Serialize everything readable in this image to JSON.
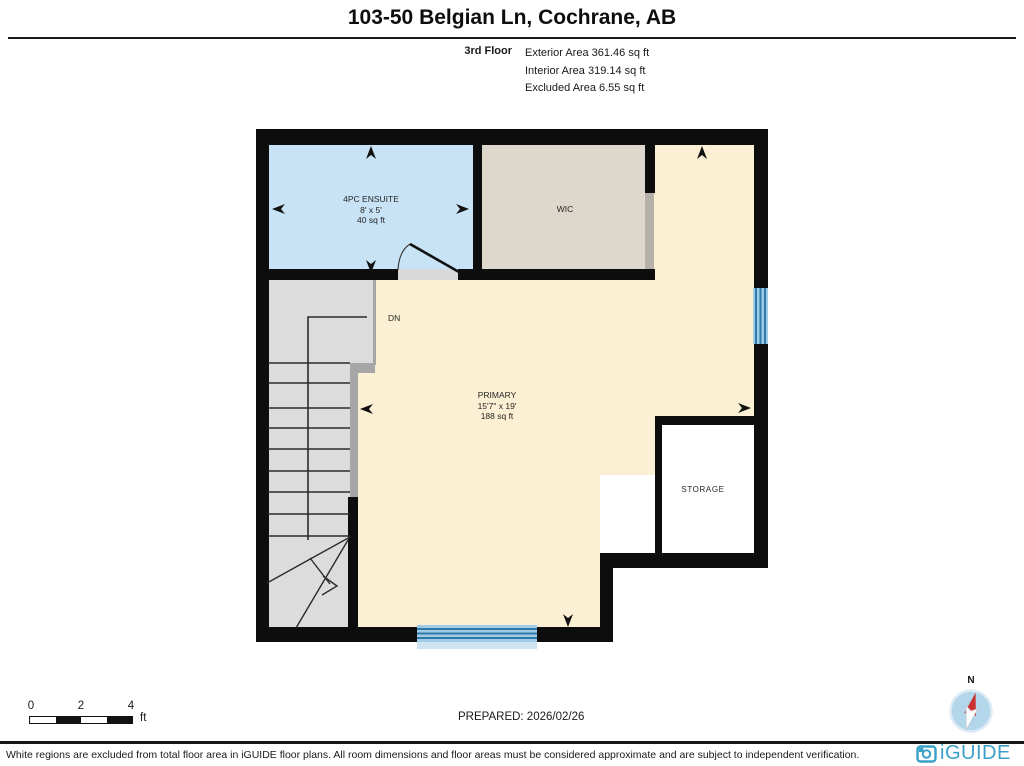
{
  "header": {
    "title": "103-50 Belgian Ln, Cochrane, AB",
    "floor_label": "3rd Floor",
    "exterior_area": "Exterior Area 361.46 sq ft",
    "interior_area": "Interior Area 319.14 sq ft",
    "excluded_area": "Excluded Area 6.55 sq ft"
  },
  "floorplan": {
    "rooms": {
      "ensuite": {
        "label": "4PC ENSUITE",
        "dims": "8' x 5'",
        "area": "40 sq ft",
        "fill": "#c7e3f5"
      },
      "wic": {
        "label": "WIC",
        "fill": "#ddd8cb"
      },
      "primary": {
        "label": "PRIMARY",
        "dims": "15'7\" x 19'",
        "area": "188 sq ft",
        "fill": "#fbf0d3"
      },
      "storage": {
        "label": "STORAGE",
        "fill": "#ffffff"
      },
      "stairs": {
        "label": "DN",
        "fill": "#dcdcdc"
      }
    },
    "wall_color": "#0d0d0d",
    "window_color": "#2f79a8"
  },
  "scale_bar": {
    "tick_labels": [
      "0",
      "2",
      "4"
    ],
    "unit": "ft"
  },
  "prepared_label": "PREPARED: 2026/02/26",
  "compass": {
    "north_label": "N"
  },
  "branding": {
    "logo_text": "iGUIDE",
    "brand_color": "#3aa0c8"
  },
  "footer": {
    "disclaimer": "White regions are excluded from total floor area in iGUIDE floor plans. All room dimensions and floor areas must be considered approximate and are subject to independent verification."
  }
}
